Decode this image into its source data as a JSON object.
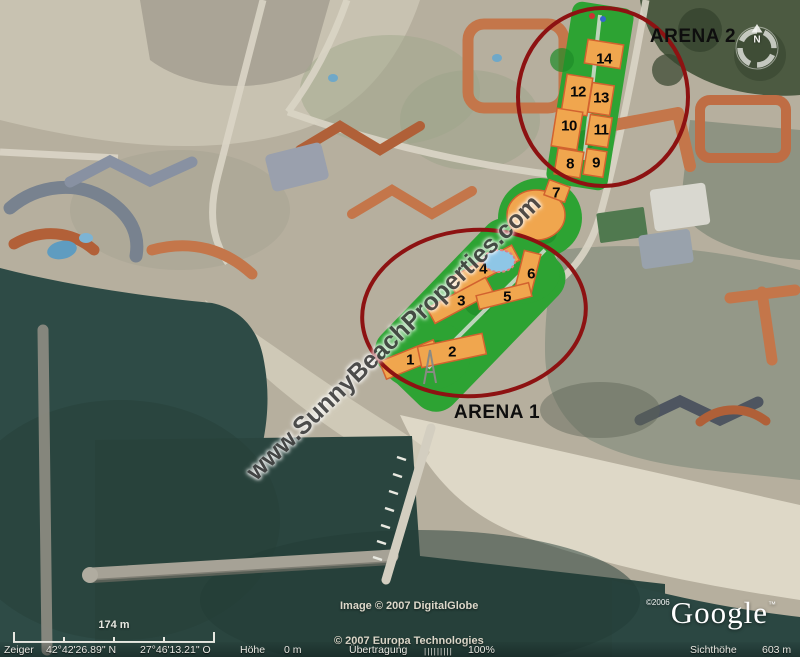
{
  "labels": {
    "arena1": "ARENA 1",
    "arena2": "ARENA 2"
  },
  "plan": {
    "buildings": [
      {
        "label": "1"
      },
      {
        "label": "2"
      },
      {
        "label": "3"
      },
      {
        "label": "4"
      },
      {
        "label": "5"
      },
      {
        "label": "6"
      },
      {
        "label": "7"
      },
      {
        "label": "8"
      },
      {
        "label": "9"
      },
      {
        "label": "10"
      },
      {
        "label": "11"
      },
      {
        "label": "12"
      },
      {
        "label": "13"
      },
      {
        "label": "14"
      }
    ],
    "accent_green": "#2da333",
    "building_color": "#f0a64e",
    "circle_color": "#8d1212",
    "pool_color": "#8ec6e6"
  },
  "watermark": {
    "text": "www.SunnyBeachProperties.com"
  },
  "compass": {
    "north_label": "N"
  },
  "attribution": {
    "image_credit": "Image © 2007 DigitalGlobe",
    "map_credit": "© 2007 Europa Technologies",
    "google_copyright": "©2006",
    "google_name": "Google",
    "google_tm": "™"
  },
  "scale_bar": {
    "label": "174 m"
  },
  "status_bar": {
    "pointer_label": "Zeiger",
    "lat": "42°42'26.89\" N",
    "lon": "27°46'13.21\" O",
    "elevation_label": "Höhe",
    "elevation_value": "0 m",
    "streaming_label": "Übertragung",
    "streaming_bars": "|||||||||",
    "streaming_value": "100%",
    "eye_alt_label": "Sichthöhe",
    "eye_alt_value": "603 m"
  }
}
